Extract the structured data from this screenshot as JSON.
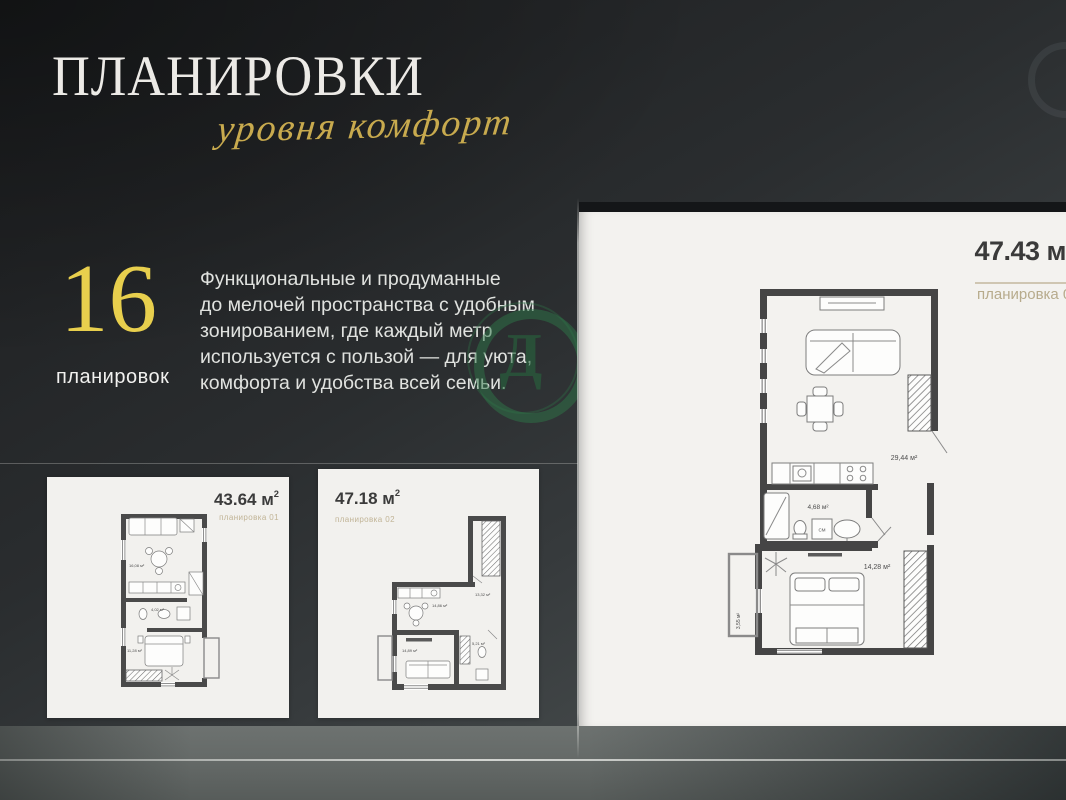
{
  "header": {
    "title": "ПЛАНИРОВКИ",
    "tagline": "уровня комфорт"
  },
  "intro": {
    "count": "16",
    "count_label": "планировок",
    "description_lines": [
      "Функциональные и продуманные",
      "до мелочей пространства с удобным",
      "зонированием, где каждый метр",
      "используется с пользой — для уюта,",
      "комфорта и удобства всей семьи."
    ]
  },
  "watermark": {
    "letter": "Д"
  },
  "plans": {
    "small1": {
      "area": "43.64 м",
      "area_sup": "2",
      "label": "планировка 01",
      "rooms": {
        "living": "16,08 м²",
        "bath": "4,02 м²",
        "bedroom": "11,28 м²"
      }
    },
    "small2": {
      "area": "47.18 м",
      "area_sup": "2",
      "label": "планировка 02",
      "rooms": {
        "hall": "13,32 м²",
        "kitchen": "14,86 м²",
        "living": "14,89 м²",
        "bath": "5,21 м²"
      }
    },
    "large": {
      "area": "47.43 м",
      "area_sup": "",
      "label": "планировка 0",
      "rooms": {
        "living": "29,44 м²",
        "bath": "4,68 м²",
        "bedroom": "14,28 м²",
        "balcony": "3,55 м²"
      },
      "washer": "СМ"
    }
  },
  "colors": {
    "accent_gold": "#c8aa4e",
    "count_gold": "#e8cf4d",
    "watermark_green": "#2e7648",
    "plan_label_tan": "#b7ab8c",
    "page_dark": "#2a2d2f",
    "card_white": "#f2f1ee"
  }
}
